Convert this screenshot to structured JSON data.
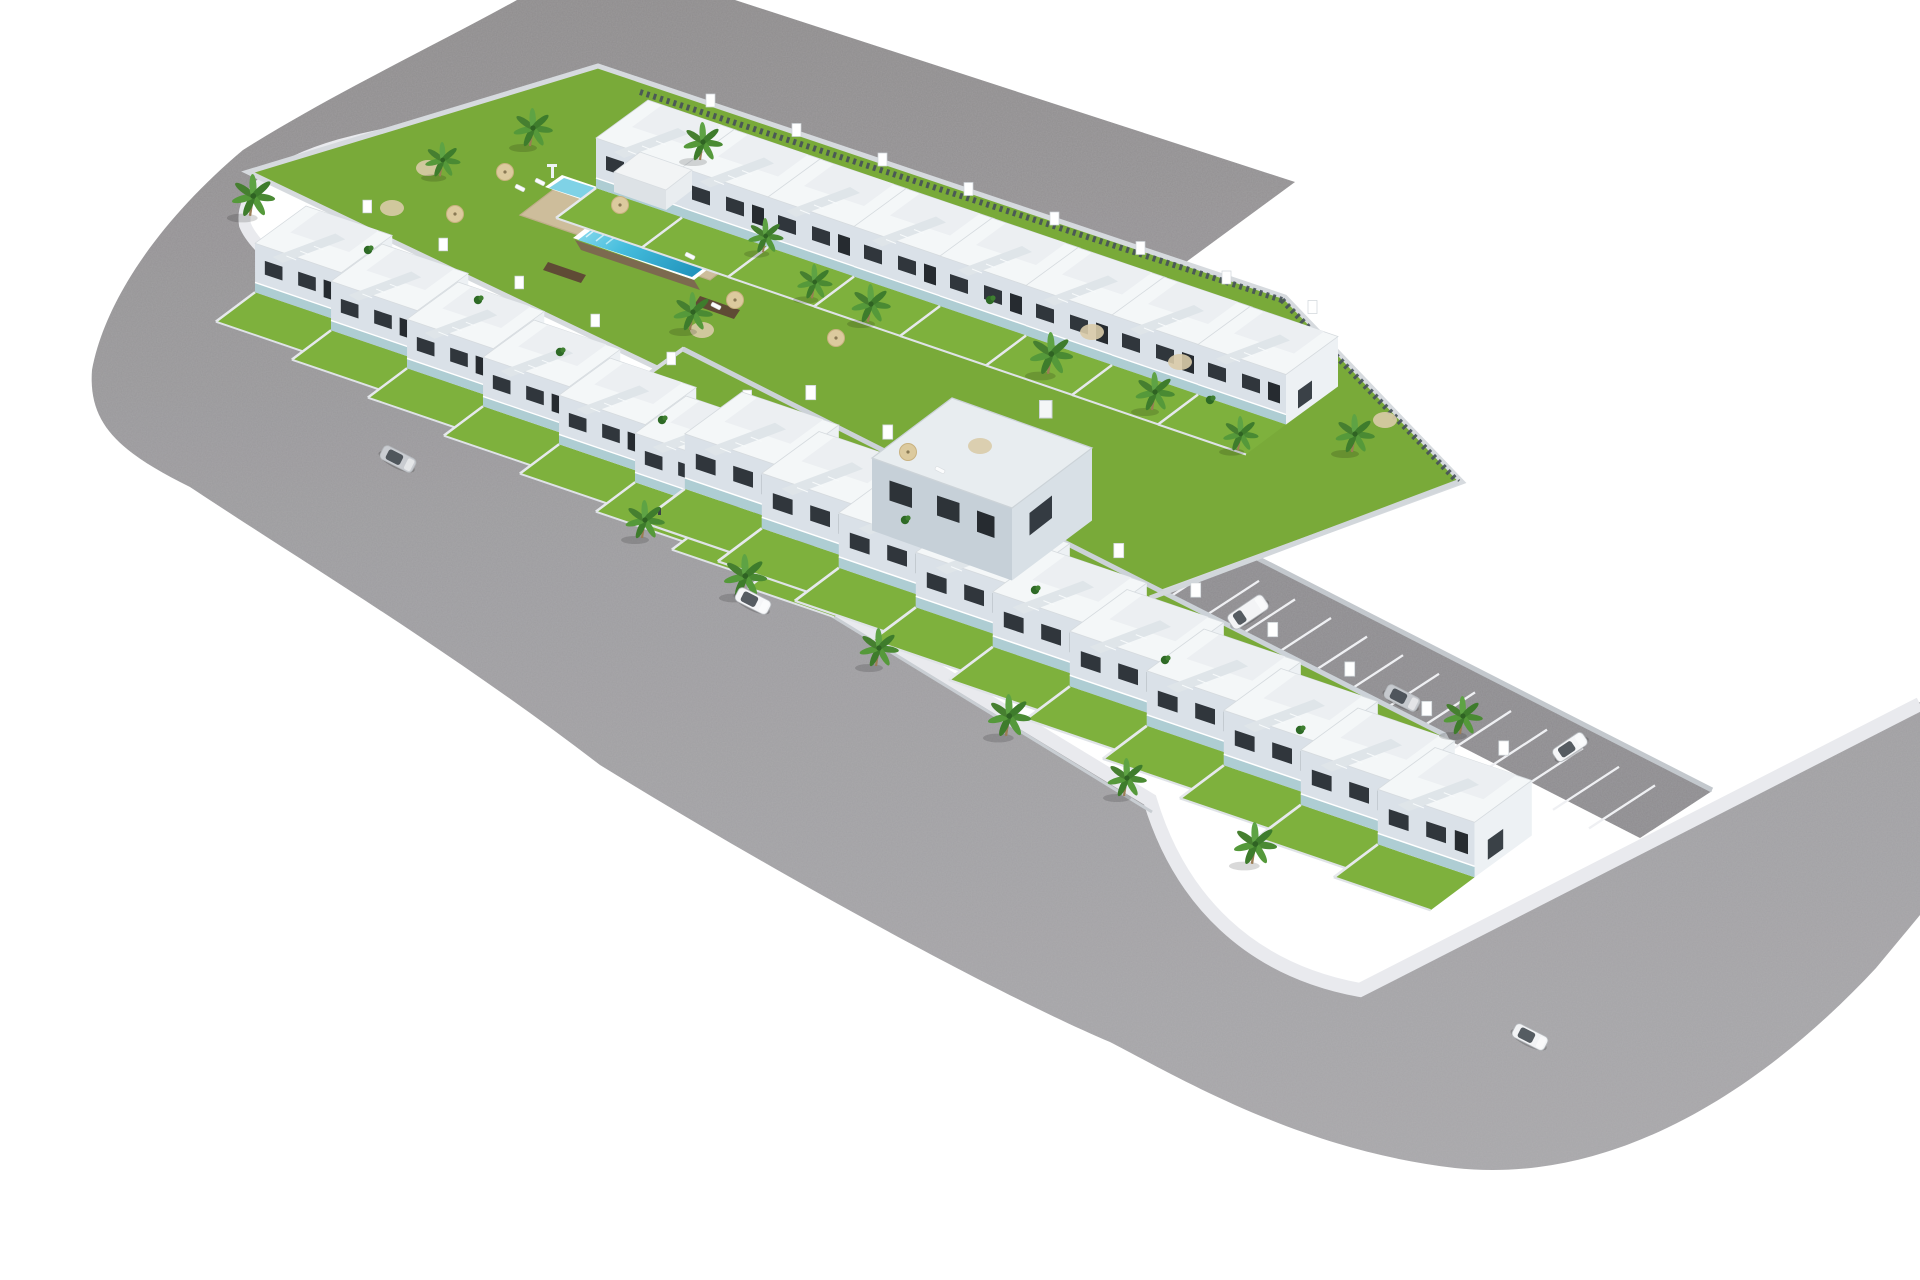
{
  "scene": {
    "title": "aerial-3d-render-residential-development",
    "description": "Photorealistic isometric render of an L-shaped residential complex of white two-storey townhouses with roof terraces, private gardens, communal lawn with lap pool and kids pool, wrap-around asphalt streets with rounded corners, a marked parking strip and several cars, on a plain white background.",
    "background_color": "#ffffff",
    "visible_text": ""
  },
  "palette": {
    "road_dark": "#8e8b8c",
    "road_light": "#a8a7aa",
    "parking_asphalt": "#8d8b8f",
    "sidewalk": "#e9eaee",
    "curb_wall": "#d3d8dc",
    "dark_fence": "#46505a",
    "grass": "#79aa39",
    "grass_private": "#7eb13d",
    "pool_deep": "#2fa8cf",
    "pool_shallow": "#96dff0",
    "pool_deck": "#cdbd9b",
    "house_roof": "#f4f7f8",
    "house_front": "#dae1e8",
    "house_side": "#edf1f4",
    "window": "#30363c",
    "balcony_glass": "#9fc6cc",
    "palm_frond": "#4a8a33",
    "plank_path": "#5f4b35",
    "car_silver": "#c9ccd1",
    "car_white": "#f5f6f8"
  },
  "development": {
    "communal_pool": {
      "main_pool": 1,
      "kids_pool": 1,
      "sun_loungers": 5,
      "parasols": 6
    },
    "utility_shed": 1,
    "corner_building": 1,
    "pedestrians": 1,
    "house_rows": [
      {
        "id": "row-north",
        "units": 8,
        "start": [
          648,
          100
        ],
        "step": [
          86,
          29.5
        ],
        "scale": 1.0
      },
      {
        "id": "row-west",
        "units": 8,
        "start": [
          306,
          206
        ],
        "step": [
          76,
          38
        ],
        "scale": 0.98
      },
      {
        "id": "row-south",
        "units": 10,
        "start": [
          742,
          392
        ],
        "step": [
          77,
          39.5
        ],
        "scale": 1.1
      }
    ],
    "parking": {
      "bays": 20,
      "lines_start": [
        905,
        475
      ],
      "lines_step": [
        36,
        18.6
      ],
      "line_vector": [
        66,
        -43
      ]
    }
  },
  "vehicles": [
    {
      "type": "sedan",
      "color": "#c9ccd1",
      "x": 398,
      "y": 459,
      "angle": 27
    },
    {
      "type": "sedan",
      "color": "#f5f6f8",
      "x": 753,
      "y": 601,
      "angle": 27
    },
    {
      "type": "van",
      "color": "#f3f4f6",
      "x": 1248,
      "y": 612,
      "angle": -34
    },
    {
      "type": "sedan",
      "color": "#c6c9ce",
      "x": 1402,
      "y": 698,
      "angle": 27
    },
    {
      "type": "sedan",
      "color": "#f5f6f8",
      "x": 1570,
      "y": 747,
      "angle": -34
    },
    {
      "type": "sedan",
      "color": "#f2f3f5",
      "x": 1530,
      "y": 1037,
      "angle": 27
    }
  ],
  "palms": [
    [
      250,
      196,
      1.1
    ],
    [
      440,
      160,
      0.9
    ],
    [
      530,
      128,
      1.0
    ],
    [
      700,
      142,
      1.0
    ],
    [
      763,
      236,
      0.9
    ],
    [
      690,
      312,
      1.0
    ],
    [
      812,
      282,
      0.9
    ],
    [
      868,
      304,
      1.0
    ],
    [
      1048,
      354,
      1.1
    ],
    [
      1152,
      392,
      1.0
    ],
    [
      1238,
      434,
      0.9
    ],
    [
      1352,
      434,
      1.0
    ],
    [
      642,
      520,
      1.0
    ],
    [
      742,
      576,
      1.1
    ],
    [
      876,
      648,
      1.0
    ],
    [
      1006,
      716,
      1.1
    ],
    [
      1124,
      778,
      1.0
    ],
    [
      1252,
      844,
      1.1
    ],
    [
      1460,
      716,
      1.0
    ]
  ],
  "parasols": [
    [
      505,
      172
    ],
    [
      455,
      214
    ],
    [
      620,
      205
    ],
    [
      735,
      300
    ],
    [
      836,
      338
    ],
    [
      908,
      452
    ]
  ],
  "loungers": [
    [
      520,
      188
    ],
    [
      540,
      182
    ],
    [
      690,
      256
    ],
    [
      716,
      306
    ],
    [
      940,
      470
    ]
  ],
  "gravel_patches": [
    [
      428,
      168
    ],
    [
      392,
      208
    ],
    [
      702,
      330
    ],
    [
      980,
      446
    ],
    [
      1092,
      332
    ],
    [
      1180,
      362
    ],
    [
      1385,
      420
    ]
  ],
  "bushes": [
    [
      368,
      250
    ],
    [
      478,
      300
    ],
    [
      560,
      352
    ],
    [
      662,
      420
    ],
    [
      905,
      520
    ],
    [
      1035,
      590
    ],
    [
      1165,
      660
    ],
    [
      1300,
      730
    ],
    [
      990,
      300
    ],
    [
      1210,
      400
    ]
  ],
  "pedestrian": [
    658,
    508
  ]
}
